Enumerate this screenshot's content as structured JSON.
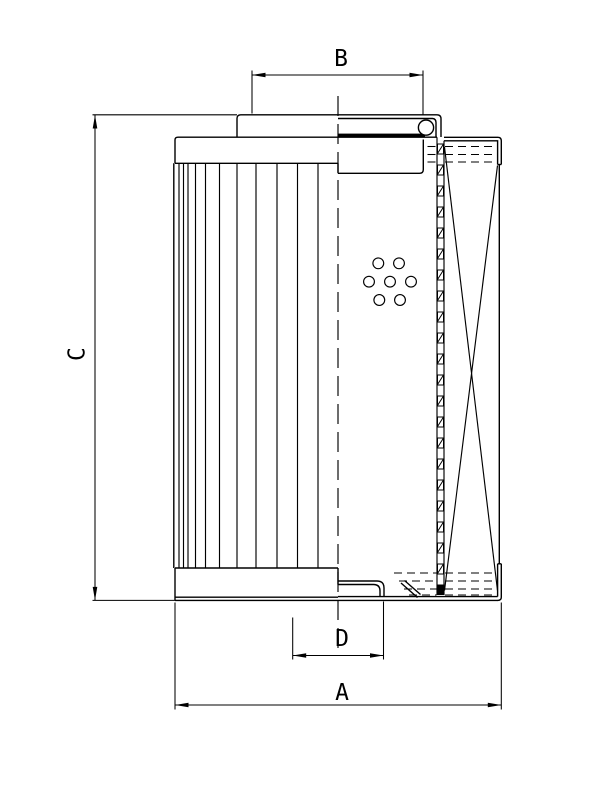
{
  "drawing": {
    "kind": "technical line drawing - filter element section",
    "background_color": "#ffffff",
    "line_color": "#000000",
    "dimensions": {
      "a": {
        "label": "A",
        "orientation": "horizontal",
        "position": "bottom overall width"
      },
      "b": {
        "label": "B",
        "orientation": "horizontal",
        "position": "top cap width"
      },
      "c": {
        "label": "C",
        "orientation": "vertical",
        "position": "left overall height"
      },
      "d": {
        "label": "D",
        "orientation": "horizontal",
        "position": "bottom spigot width"
      }
    }
  }
}
